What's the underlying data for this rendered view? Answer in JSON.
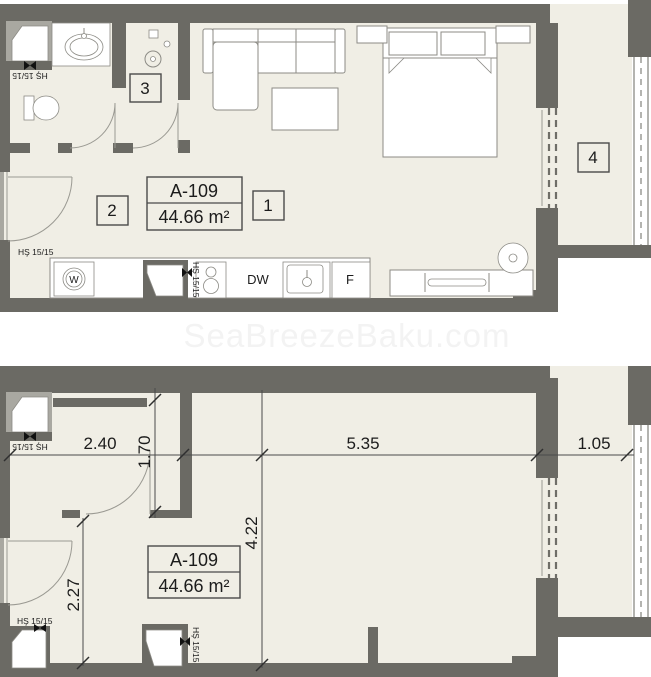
{
  "colors": {
    "wall": "#6b6a64",
    "wall-light": "#a9a8a1",
    "floor": "#f0eee5",
    "stroke": "#8c8b85",
    "dim-line": "#4a4a4a",
    "text": "#1c1c1c",
    "watermark": "#f3f3f3"
  },
  "watermark": {
    "text": "SeaBreezeBaku.com"
  },
  "unit_label": {
    "code": "A-109",
    "area": "44.66 m²"
  },
  "room_numbers": {
    "living": "1",
    "hall": "2",
    "wardrobe": "3",
    "balcony": "4"
  },
  "appliance_labels": {
    "washer": "W",
    "dishwasher": "DW",
    "fridge": "F"
  },
  "shaft_label": {
    "text": "HŞ 15/15"
  },
  "dimensions": {
    "bath_width": "2.40",
    "wardrobe_width": "1.70",
    "living_width": "5.35",
    "balcony_width": "1.05",
    "living_depth": "4.22",
    "entry_depth": "2.27"
  }
}
